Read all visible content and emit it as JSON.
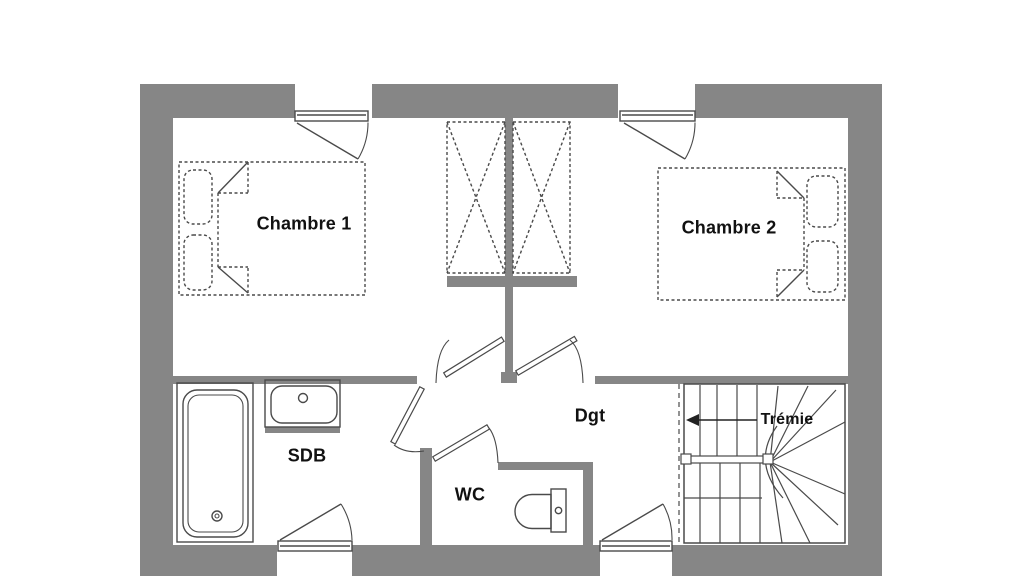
{
  "plan": {
    "type": "floor-plan",
    "floor": "étage",
    "rooms": {
      "chambre1": {
        "label": "Chambre 1"
      },
      "chambre2": {
        "label": "Chambre 2"
      },
      "sdb": {
        "label": "SDB"
      },
      "wc": {
        "label": "WC"
      },
      "dgt": {
        "label": "Dgt"
      },
      "tremie": {
        "label": "Trémie"
      }
    },
    "fixtures": [
      "double-bed-chambre-1",
      "double-bed-chambre-2",
      "wardrobe-left",
      "wardrobe-right",
      "bathtub",
      "sink",
      "toilet",
      "winder-staircase",
      "stair-direction-arrow",
      "window-top-left",
      "window-top-right",
      "window-bottom-left",
      "window-bottom-right",
      "door-chambre-1",
      "door-chambre-2",
      "door-sdb",
      "door-wc"
    ],
    "colors": {
      "wall": "#868686",
      "line": "#4a4a4a",
      "text": "#111111",
      "background": "#ffffff"
    }
  }
}
